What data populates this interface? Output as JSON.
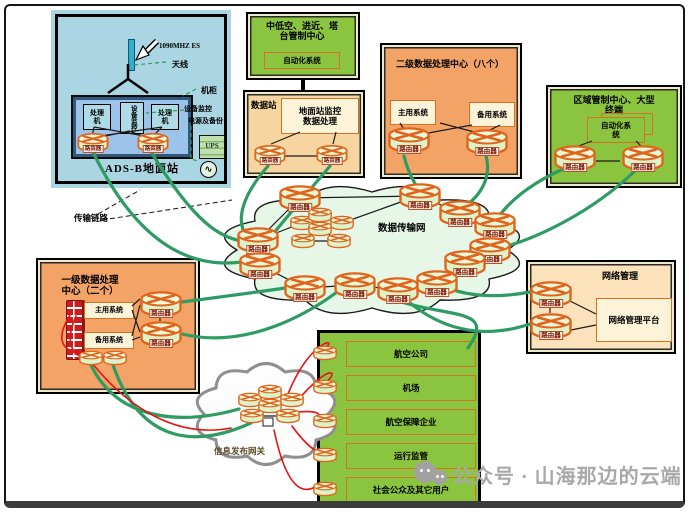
{
  "labels": {
    "router": "路由器",
    "transmission_link": "传输链路"
  },
  "watermark": {
    "text": "公众号 · 山海那边的云端"
  },
  "ads_b": {
    "title": "ADS-B地面站",
    "signal": "1090MHZ ES",
    "antenna": "天线",
    "cabinet": "机柜",
    "processor": "处理\n机",
    "monitor_unit": "设备监控",
    "device_monitor": "设备监控",
    "power_backup": "电源及备份",
    "ups": "UPS",
    "ac_icon": "∿"
  },
  "tower_center": {
    "title": "中低空、进近、塔\n台管制中心",
    "automation": "自动化系统"
  },
  "data_station": {
    "title": "数据站",
    "monitor": "地面站监控\n数据处理"
  },
  "secondary_center": {
    "title": "二级数据处理中心（八个）",
    "main_system": "主用系统",
    "backup_system": "备用系统"
  },
  "regional_center": {
    "title": "区域管制中心、大型\n终端",
    "automation": "自动化系\n统"
  },
  "cloud": {
    "label": "数据传输网"
  },
  "primary_center": {
    "title": "一级数据处理\n中心（二个）",
    "main_system": "主用系统",
    "backup_system": "备用系统"
  },
  "network_mgmt": {
    "title": "网络管理",
    "platform": "网络管理平台"
  },
  "gateway": {
    "label": "信息发布网关"
  },
  "users": {
    "rows": [
      "航空公司",
      "机场",
      "航空保障企业",
      "运行监管",
      "社会公众及其它用户"
    ]
  },
  "colors": {
    "green_box": "#8bc53f",
    "orange_box": "#f2a365",
    "blue_box": "#a9d6e2",
    "tan_box": "#f6d5a0",
    "peach_box": "#fbe2ba",
    "cream_box": "#fcf3d8",
    "cloud_fill": "#e6f7e8",
    "link_green": "#2e9c62",
    "link_red": "#e51414",
    "router_orange": "#e2641c"
  }
}
